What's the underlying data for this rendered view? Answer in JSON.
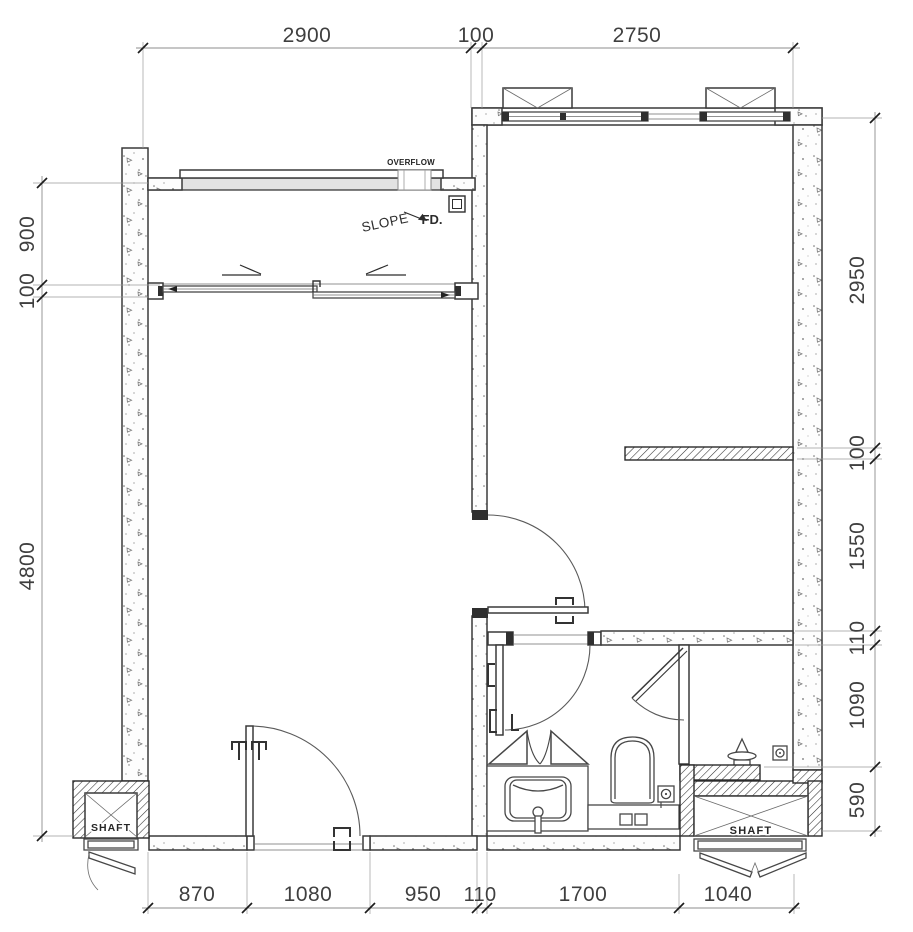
{
  "drawing": {
    "background": "#ffffff",
    "wall_line_color": "#3a3a3a",
    "dimension_line_color": "#8c8c8c",
    "text_color": "#3f3f3f",
    "rail_fill": "#e2e2e2"
  },
  "labels": {
    "overflow": "OVERFLOW",
    "slope": "SLOPE",
    "fd": "FD.",
    "shaft_left": "SHAFT",
    "shaft_right": "SHAFT"
  },
  "dims": {
    "top": [
      "2900",
      "100",
      "2750"
    ],
    "left": [
      "900",
      "100",
      "4800"
    ],
    "right": [
      "2950",
      "100",
      "1550",
      "110",
      "1090",
      "590"
    ],
    "bottom": [
      "870",
      "1080",
      "950",
      "110",
      "1700",
      "1040"
    ]
  }
}
